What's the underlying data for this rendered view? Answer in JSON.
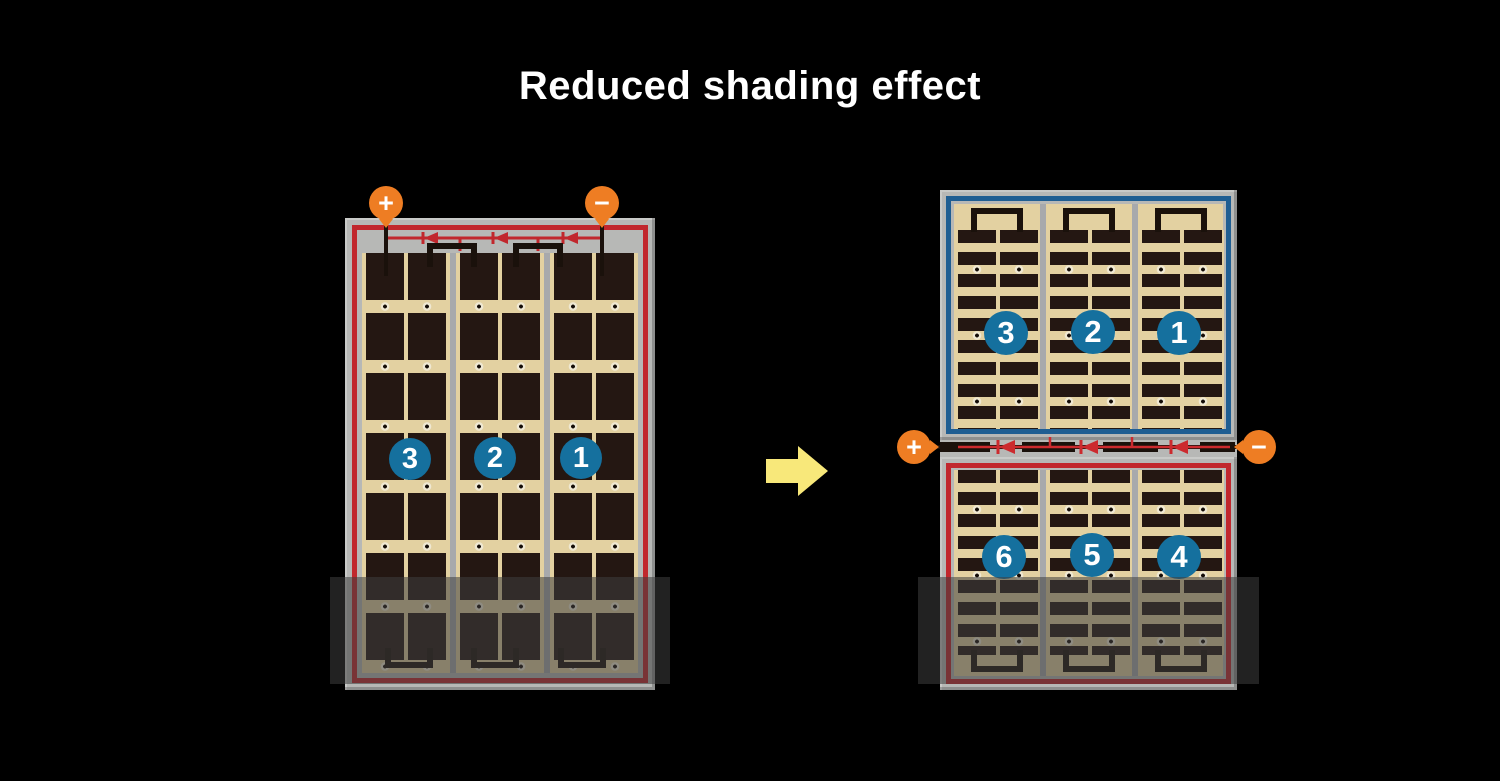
{
  "title": "Reduced shading effect",
  "colors": {
    "background": "#000000",
    "frame_gray": "#b7b8b6",
    "cell_tan": "#e3d1a1",
    "cell_dark": "#241712",
    "wire_red": "#c1272d",
    "wire_blue": "#1f5e92",
    "wire_black": "#1a110b",
    "circle_blue": "#15709e",
    "terminal_orange": "#ee7d23",
    "arrow_yellow": "#f8e87a",
    "shade_overlay": "rgba(62,62,62,0.55)"
  },
  "left_panel": {
    "terminals": {
      "plus": "+",
      "minus": "−"
    },
    "section_labels": [
      "3",
      "2",
      "1"
    ]
  },
  "right_assembly": {
    "terminals": {
      "plus": "+",
      "minus": "−"
    },
    "top_panel": {
      "section_labels": [
        "3",
        "2",
        "1"
      ]
    },
    "bottom_panel": {
      "section_labels": [
        "6",
        "5",
        "4"
      ]
    }
  }
}
